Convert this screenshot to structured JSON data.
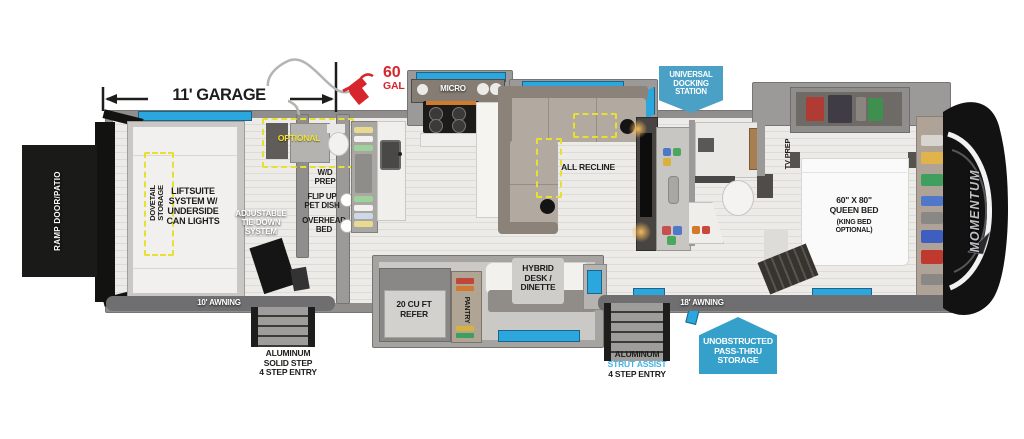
{
  "title": "Toy hauler fifth wheel floor plan",
  "colors": {
    "callout_blue": "#4aa0c5",
    "window_blue": "#2ba7de",
    "highlight_yellow": "#f0e32c",
    "alert_red": "#d6252c",
    "strut_cyan": "#3eb3e4"
  },
  "garage": {
    "dimension": "11' GARAGE",
    "fuel_qty": "60",
    "fuel_unit": "GAL",
    "ramp": "RAMP DOOR/PATIO",
    "dovetail": "DOVETAIL\nSTORAGE",
    "liftsuite": "LIFTSUITE\nSYSTEM w/\nUNDERSIDE\nCAN LIGHTS",
    "tiedown": "ADJUSTABLE\nTIE-DOWN\nSYSTEM",
    "optional": "OPTIONAL",
    "awning": "10' AWNING"
  },
  "utility": {
    "wd_prep": "W/D\nPREP",
    "pet_dish": "FLIP UP\nPET DISH",
    "overhead_bed": "OVERHEAD\nBED"
  },
  "kitchen": {
    "micro": "MICRO",
    "refer": "20 CU FT\nREFER",
    "pantry": "PANTRY",
    "desk": "HYBRID\nDESK /\nDINETTE"
  },
  "living": {
    "all_recline": "ALL RECLINE"
  },
  "bedroom": {
    "tv_prep": "TV PREP",
    "bed": "60\" x 80\"\nQUEEN BED",
    "bed_option": "(KING BED\nOPTIONAL)",
    "awning": "18' AWNING"
  },
  "callouts": {
    "docking": "UNIVERSAL\nDOCKING\nSTATION",
    "passthru": "UNOBSTRUCTED\nPASS-THRU\nSTORAGE",
    "steps_left": "ALUMINUM\nSOLID STEP\n4 STEP ENTRY",
    "steps_right_1": "ALUMINUM",
    "steps_right_2": "STRUT ASSIST",
    "steps_right_3": "4 STEP ENTRY"
  },
  "brand": {
    "logo": "MOMENTUM"
  }
}
